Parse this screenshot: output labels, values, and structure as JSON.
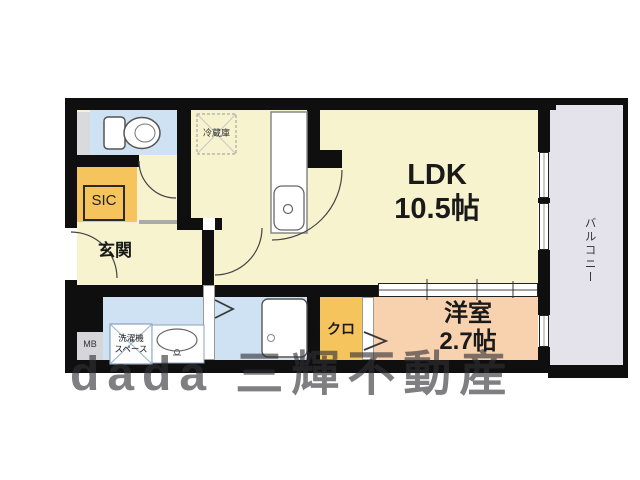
{
  "rooms": {
    "ldk": {
      "label": "LDK",
      "size": "10.5帖"
    },
    "western_room": {
      "label": "洋室",
      "size": "2.7帖"
    },
    "entrance": {
      "label": "玄関"
    },
    "shoe_closet": {
      "label": "SIC"
    },
    "closet": {
      "label": "クロ"
    },
    "balcony": {
      "label": "バルコニー"
    }
  },
  "equipment": {
    "refrigerator_space": {
      "label": "冷蔵庫"
    },
    "washer_space": {
      "label1": "洗濯機",
      "label2": "スペース"
    },
    "meter_box": {
      "label": "MB"
    }
  },
  "watermark": {
    "text": "dada 三輝不動産"
  },
  "colors": {
    "wall_black": "#0f0f0f",
    "floor_cream": "#f7f3cf",
    "wet_area_blue": "#cfe2f4",
    "closet_orange": "#f6c45c",
    "western_room_pink": "#f8d2ae",
    "balcony_gray": "#e4e3ec",
    "pipe_space_gray": "#d8dade",
    "meter_box_gray": "#d6d6da"
  }
}
